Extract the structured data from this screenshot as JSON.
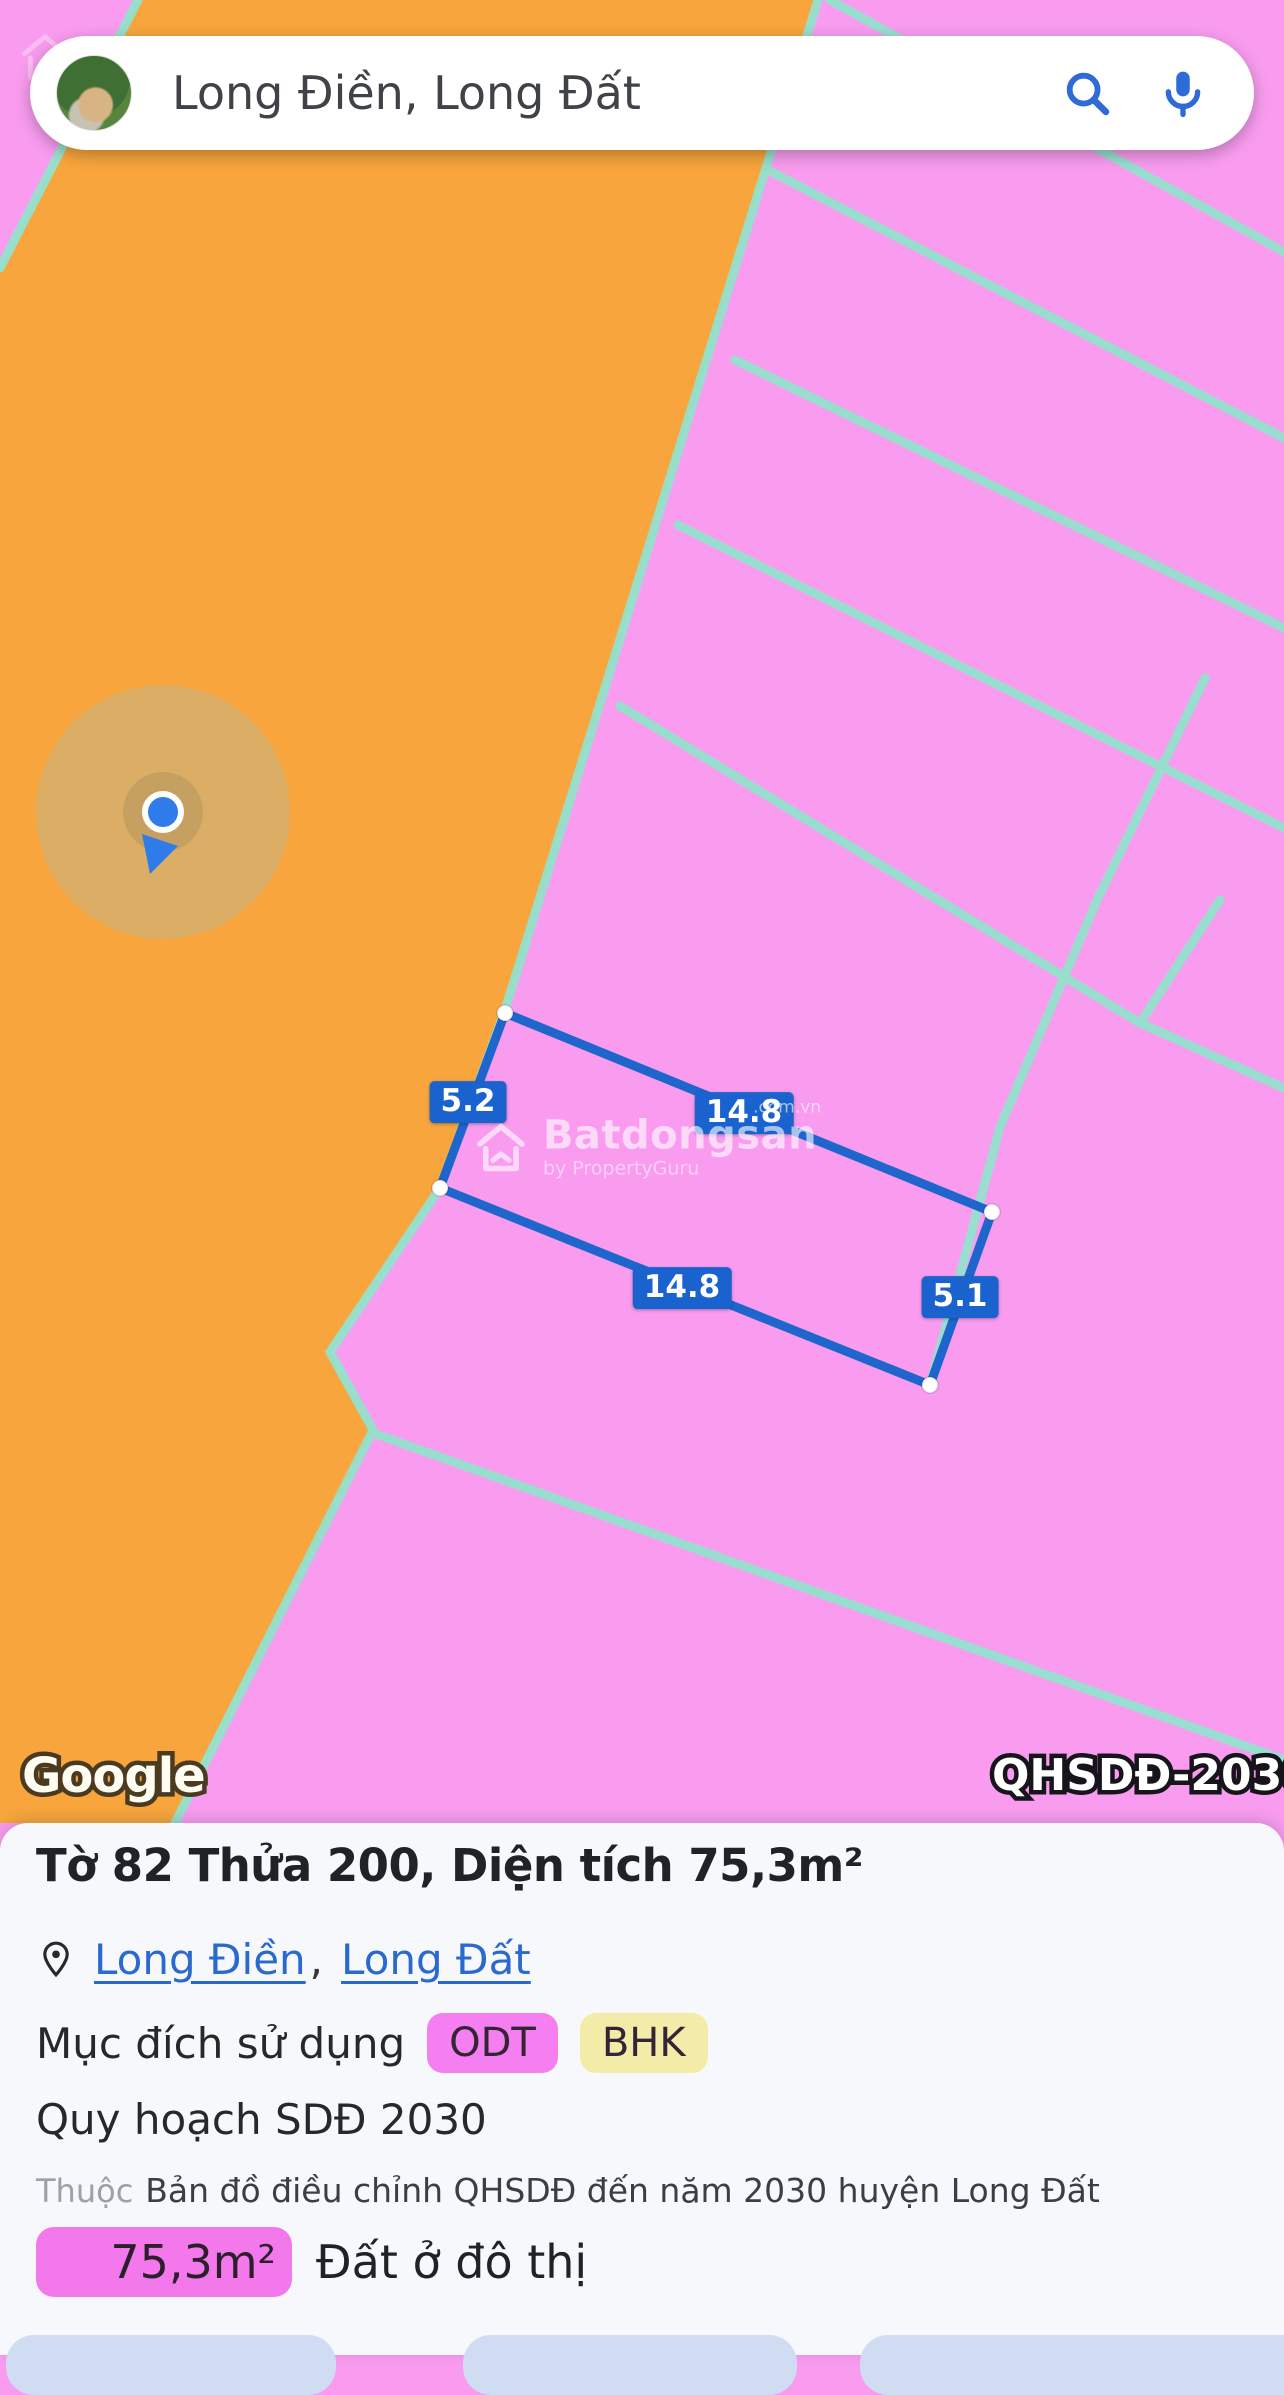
{
  "search": {
    "query": "Long Điền, Long Đất"
  },
  "map": {
    "parcel": {
      "dimensions": [
        "5.2",
        "14.8",
        "14.8",
        "5.1"
      ]
    },
    "watermark": {
      "brand": "Batdongsan",
      "suffix": ".com.vn",
      "byline": "by PropertyGuru"
    },
    "attribution": "Google",
    "plan_badge": "QHSDĐ-2030",
    "colors": {
      "orange_zone": "#F7A53C",
      "pink_zone": "#F99CEF",
      "boundary_line": "#94E1CD",
      "parcel_line": "#1E66CC",
      "location_dot": "#2E7BE9"
    }
  },
  "panel": {
    "title": "Tờ 82 Thửa 200, Diện tích 75,3m²",
    "location": {
      "link1": "Long Điền",
      "separator": ",",
      "link2": "Long Đất"
    },
    "purpose": {
      "label": "Mục đích sử dụng",
      "badges": [
        {
          "code": "ODT",
          "color": "#F57FF0"
        },
        {
          "code": "BHK",
          "color": "#F3ECA9"
        }
      ]
    },
    "plan": "Quy hoạch SDĐ 2030",
    "source": {
      "prefix": "Thuộc",
      "text": "Bản đồ điều chỉnh QHSDĐ đến năm 2030 huyện Long Đất"
    },
    "area": {
      "value": "75,3m²",
      "label": "Đất ở đô thị",
      "badge_color": "#F278EC"
    }
  }
}
